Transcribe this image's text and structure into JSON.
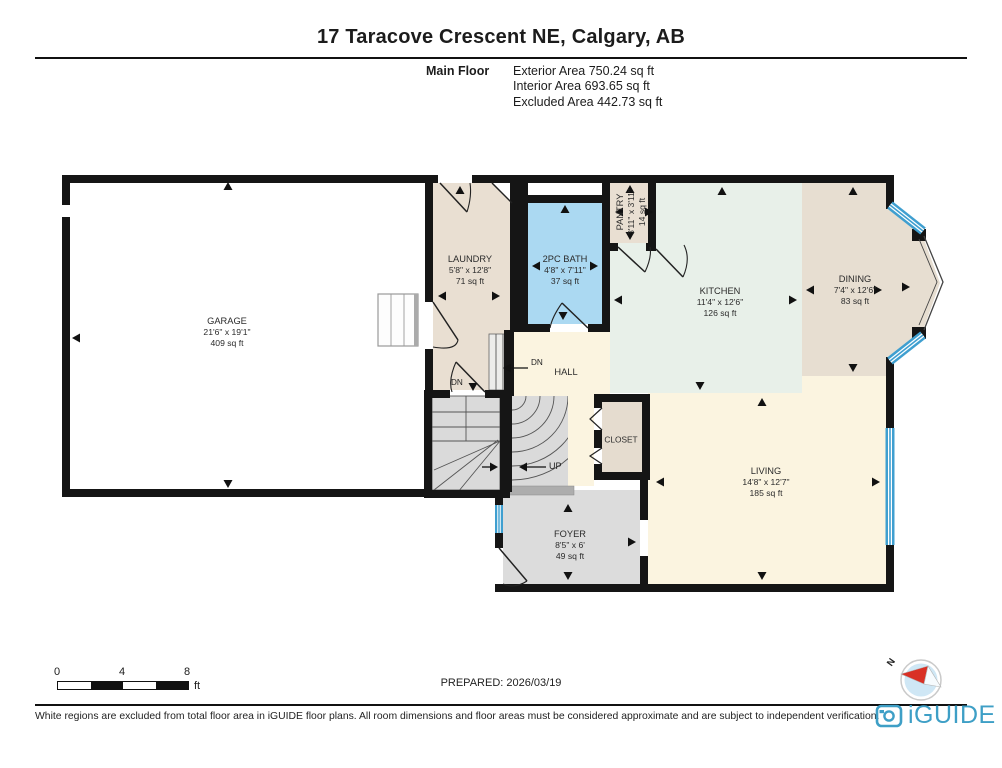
{
  "header": {
    "title": "17 Taracove Crescent NE, Calgary, AB",
    "floor_label": "Main Floor",
    "stats": [
      "Exterior Area 750.24 sq ft",
      "Interior Area 693.65 sq ft",
      "Excluded Area 442.73 sq ft"
    ]
  },
  "rooms": {
    "garage": {
      "name": "GARAGE",
      "dims": "21'6\" x 19'1\"",
      "area": "409 sq ft"
    },
    "laundry": {
      "name": "LAUNDRY",
      "dims": "5'8\" x 12'8\"",
      "area": "71 sq ft"
    },
    "bath": {
      "name": "2PC BATH",
      "dims": "4'8\" x 7'11\"",
      "area": "37 sq ft"
    },
    "pantry": {
      "name": "PANTRY",
      "dims": "3'11\" x 3'11\"",
      "area": "14 sq ft"
    },
    "kitchen": {
      "name": "KITCHEN",
      "dims": "11'4\" x 12'6\"",
      "area": "126 sq ft"
    },
    "dining": {
      "name": "DINING",
      "dims": "7'4\" x 12'6\"",
      "area": "83 sq ft"
    },
    "hall": {
      "name": "HALL"
    },
    "closet": {
      "name": "CLOSET"
    },
    "living": {
      "name": "LIVING",
      "dims": "14'8\" x 12'7\"",
      "area": "185 sq ft"
    },
    "foyer": {
      "name": "FOYER",
      "dims": "8'5\" x 6'",
      "area": "49 sq ft"
    }
  },
  "stairs": {
    "up": "UP",
    "dn1": "DN",
    "dn2": "DN"
  },
  "scale_bar": {
    "ticks": [
      "0",
      "4",
      "8"
    ],
    "unit": "ft"
  },
  "prepared_label": "PREPARED: 2026/03/19",
  "compass": {
    "north": "N"
  },
  "footer": {
    "disclaimer": "White regions are excluded from total floor area in iGUIDE floor plans. All room dimensions and floor areas must be considered approximate and are subject to independent verification.",
    "brand": "iGUIDE"
  },
  "colors": {
    "wall": "#151515",
    "bath_fill": "#abd9f2",
    "beige_fill": "#e9dfd2",
    "kitchen_fill": "#e8f0e9",
    "cream_fill": "#fbf4e0",
    "gray_fill": "#dcdcdc",
    "window_blue": "#3f9fd0",
    "brand_teal": "#3E9FC6",
    "north_red": "#d93025"
  }
}
